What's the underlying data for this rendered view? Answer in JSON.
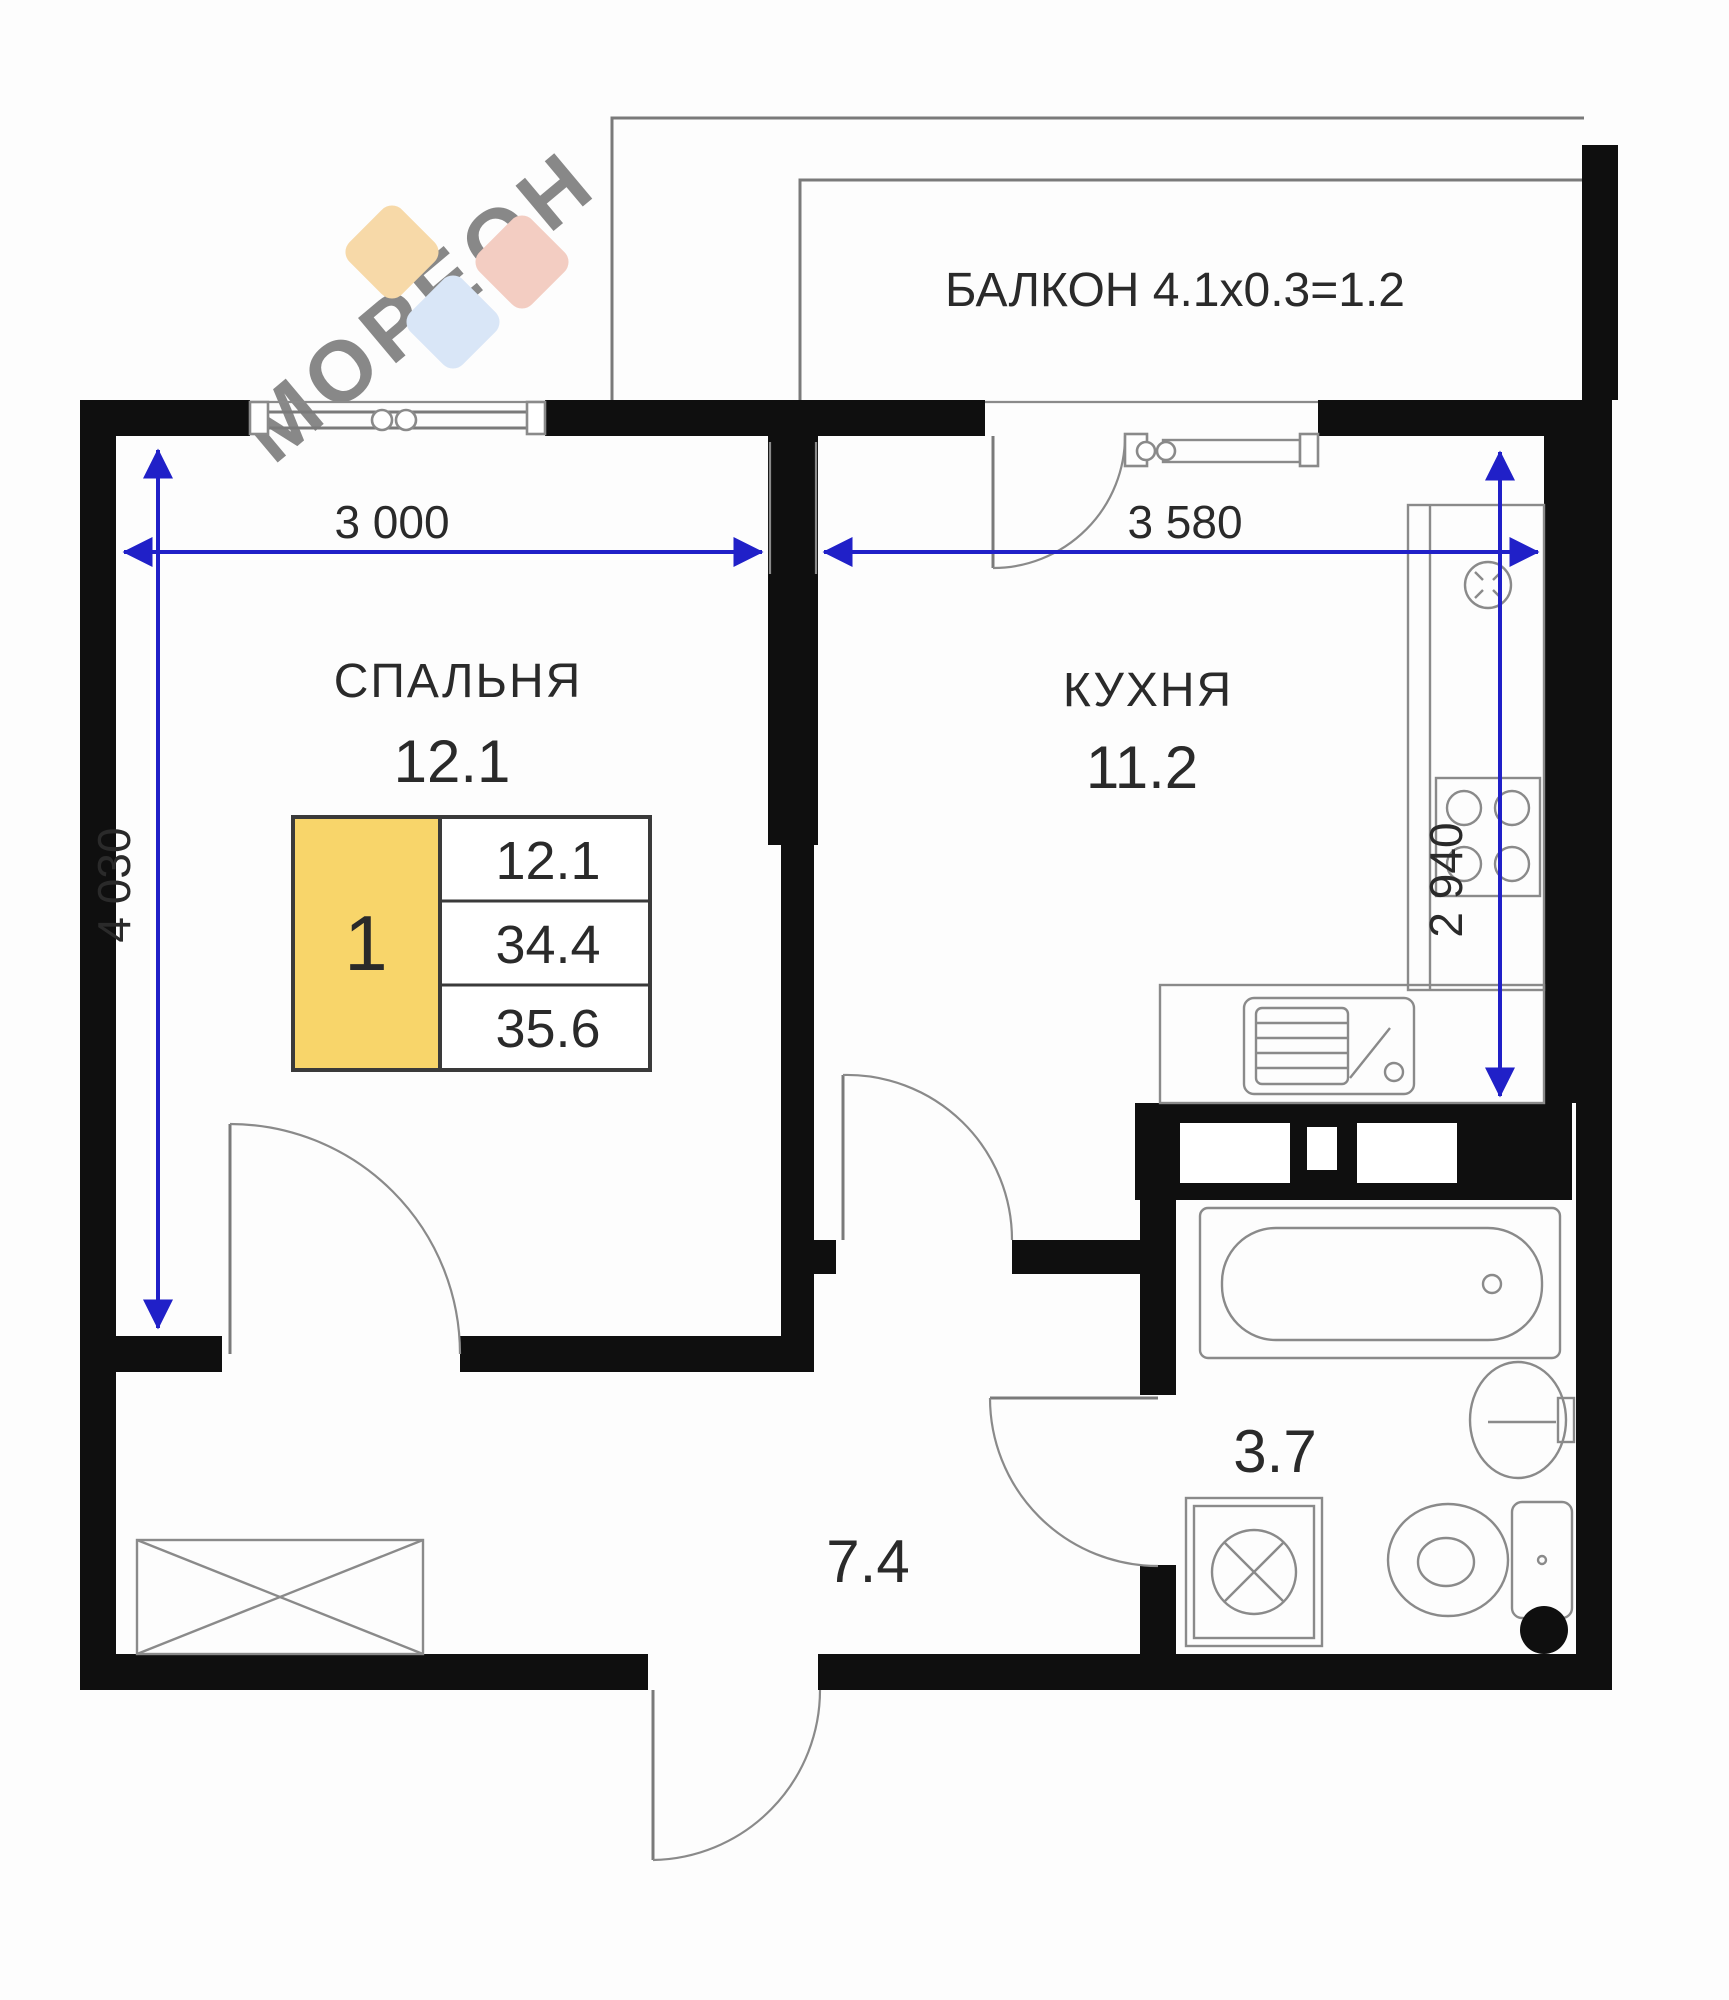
{
  "plan": {
    "balcony": {
      "label": "БАЛКОН 4.1x0.3=1.2"
    },
    "rooms": {
      "bedroom": {
        "name": "СПАЛЬНЯ",
        "area": "12.1"
      },
      "kitchen": {
        "name": "КУХНЯ",
        "area": "11.2"
      },
      "bathroom": {
        "area": "3.7"
      },
      "hallway": {
        "area": "7.4"
      }
    },
    "info_table": {
      "unit_number": "1",
      "rows": [
        {
          "value": "12.1"
        },
        {
          "value": "34.4"
        },
        {
          "value": "35.6"
        }
      ]
    },
    "dimensions": {
      "bedroom_width": "3 000",
      "kitchen_width": "3 580",
      "bedroom_height": "4 030",
      "kitchen_height": "2 940"
    },
    "watermark": "МОРЕОН",
    "colors": {
      "wall_black": "#0f0f0f",
      "dimension_blue": "#2020c8",
      "unit_cell_yellow": "#f8d56a",
      "logo_peach": "#f7d9a8",
      "logo_blue": "#d9e6f7",
      "logo_pink": "#f3cdc2",
      "watermark_gray": "#cccccc"
    }
  }
}
